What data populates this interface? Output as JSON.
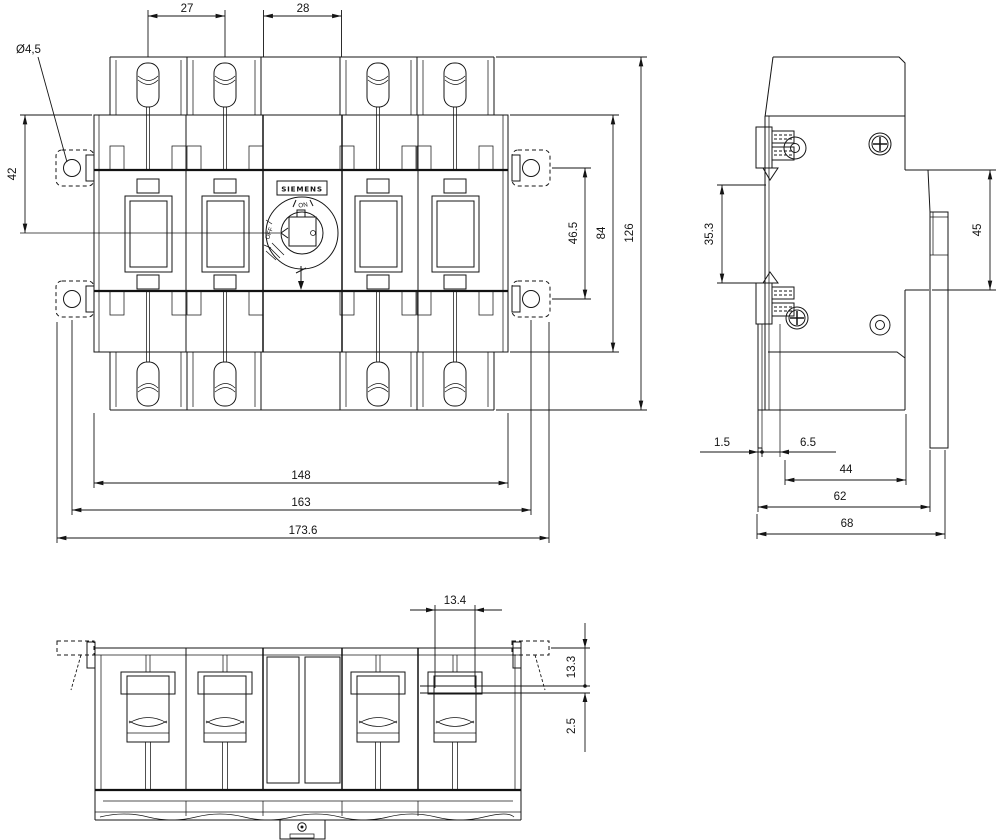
{
  "drawing": {
    "brand": "SIEMENS",
    "switch_markings": {
      "on": "ON",
      "off": "OFF"
    },
    "front_view": {
      "hole_diameter_label": "Ø4,5",
      "dim_terminal_pitch": "27",
      "dim_center_module_width": "28",
      "dim_top_to_center": "42",
      "dim_mount_hole_vspacing": "46.5",
      "dim_body_height": "84",
      "dim_overall_height": "126",
      "dim_body_width": "148",
      "dim_mount_hole_hspacing": "163",
      "dim_overall_width": "173.6"
    },
    "side_view": {
      "dim_recess_height": "35.3",
      "dim_rail_height": "45",
      "dim_front_offset": "1.5",
      "dim_cover_depth": "6.5",
      "dim_body_depth": "44",
      "dim_depth_to_rail": "62",
      "dim_overall_depth": "68"
    },
    "bottom_view": {
      "dim_terminal_width": "13.4",
      "dim_terminal_height": "13.3",
      "dim_clamp_offset": "2.5"
    },
    "colors": {
      "line": "#161616",
      "background": "#ffffff"
    }
  }
}
